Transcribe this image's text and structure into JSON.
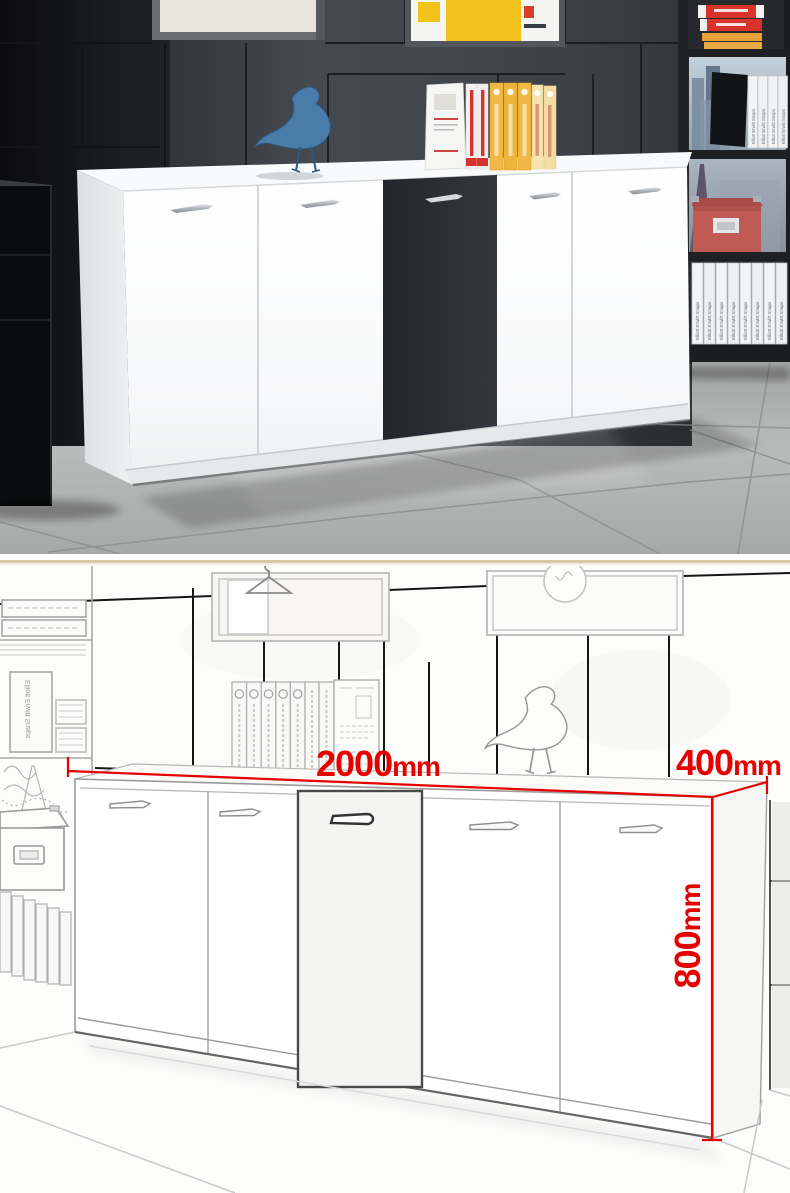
{
  "page": {
    "width": 790,
    "height": 1193
  },
  "photo": {
    "spine_text": "Elliott Erwitt Snaps",
    "colors": {
      "wall": "#45484d",
      "black_door": "#2a2d32",
      "cabinet_white": "#ffffff",
      "floor": "#b4b6b5",
      "bird_blue": "#4a7ca9",
      "storage_box_red": "#bf5a54",
      "book_red": "#d8332a",
      "book_yellow": "#f0b844"
    }
  },
  "sketch": {
    "spine_text": "Elliott Erwitt Snaps",
    "annotation_color": "#e60000",
    "dim_width": {
      "value": "2000",
      "unit": "mm"
    },
    "dim_depth": {
      "value": "400",
      "unit": "mm"
    },
    "dim_height": {
      "value": "800",
      "unit": "mm"
    }
  }
}
